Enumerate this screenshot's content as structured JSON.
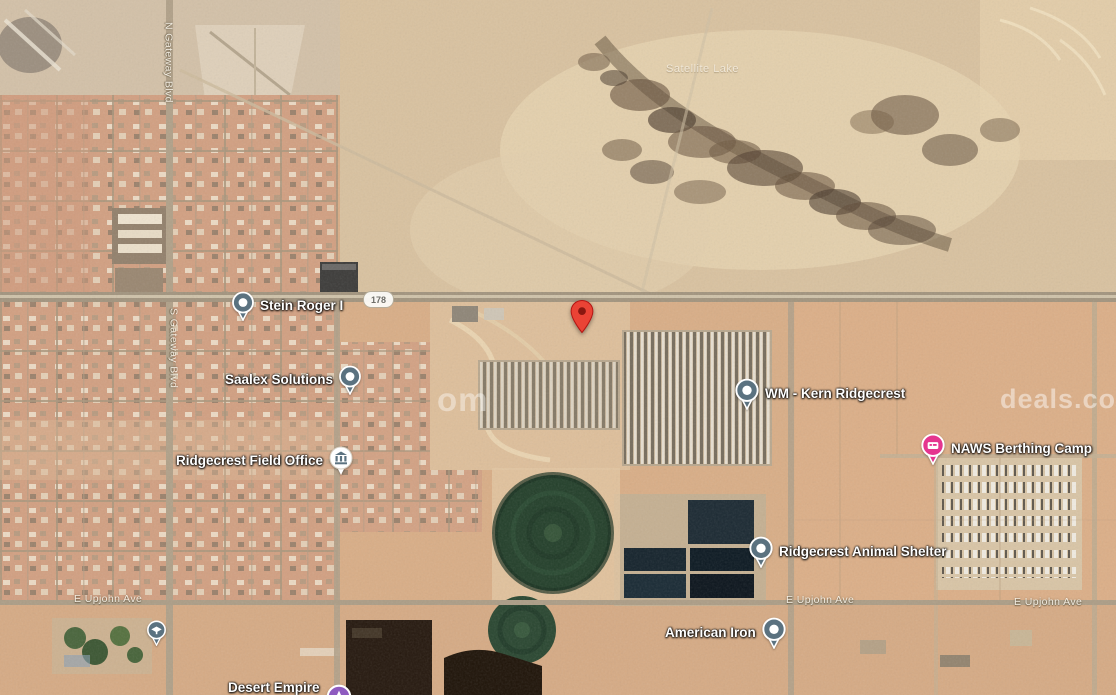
{
  "map": {
    "view": "satellite",
    "scene": "desert city edge with irrigation circles, treatment ponds and highway"
  },
  "pois": [
    {
      "label": "Stein Roger I",
      "icon": "generic-place-pin",
      "icon_side": "left",
      "icon_color": "#5b7280"
    },
    {
      "label": "Saalex Solutions",
      "icon": "generic-place-pin",
      "icon_side": "right",
      "icon_color": "#5b7280"
    },
    {
      "label": "Ridgecrest Field Office",
      "icon": "government-building-icon",
      "icon_side": "right",
      "icon_color": "#5b7280"
    },
    {
      "label": "WM - Kern Ridgecrest",
      "icon": "generic-place-pin",
      "icon_side": "left",
      "icon_color": "#5b7280"
    },
    {
      "label": "NAWS Berthing Camp",
      "icon": "lodging-pin",
      "icon_side": "left",
      "icon_color": "#e5358f"
    },
    {
      "label": "Ridgecrest Animal Shelter",
      "icon": "generic-place-pin",
      "icon_side": "left",
      "icon_color": "#5b7280"
    },
    {
      "label": "American Iron",
      "icon": "generic-place-pin",
      "icon_side": "right",
      "icon_color": "#5b7280"
    },
    {
      "label": "Desert Empire",
      "label_line2": "Fairgrounds",
      "icon": "attraction-pin",
      "icon_side": "right",
      "icon_color": "#8e5bbf"
    }
  ],
  "unlabeled_pois": [
    {
      "icon": "school-pin",
      "icon_color": "#5b7280"
    }
  ],
  "destination_pin": {
    "icon": "red-map-pin",
    "color": "#EA4335"
  },
  "road_shields": [
    {
      "route": "178"
    }
  ],
  "street_labels": {
    "n_gateway": "N Gateway Blvd",
    "s_gateway": "S Gateway Blvd",
    "upjohn": "E Upjohn Ave"
  },
  "area_labels": {
    "lake": "Satellite Lake"
  },
  "watermark": {
    "fragment_mid": "om",
    "fragment_right": "deals.co"
  },
  "colors": {
    "desert_base": "#d9ae87",
    "urban_base": "#d2a082",
    "road": "#a99a84",
    "pivot_field": "#24402b",
    "pond_dark": "#121e26",
    "pin_gray": "#5b7280",
    "pin_pink": "#e5358f",
    "pin_purple": "#8e5bbf",
    "pin_red": "#EA4335"
  }
}
